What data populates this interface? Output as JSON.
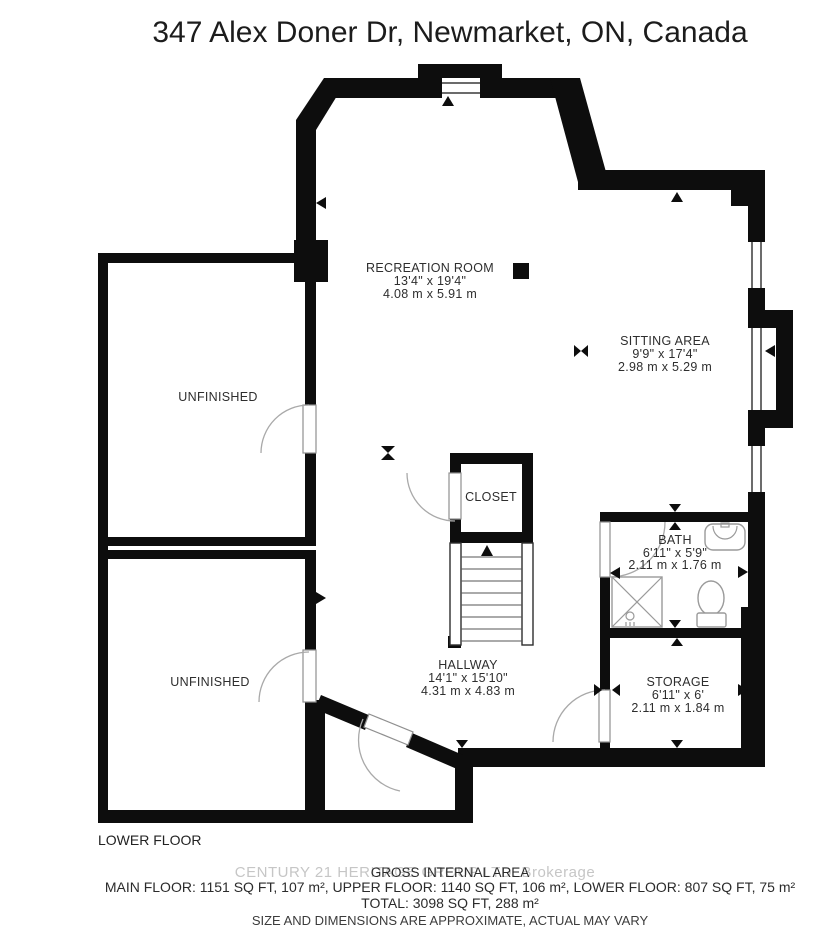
{
  "title": "347 Alex Doner Dr, Newmarket, ON, Canada",
  "floor_label": "LOWER FLOOR",
  "watermark": "CENTURY 21 HERITAGE GROUP LTD. Brokerage",
  "rooms": {
    "recreation": {
      "name": "RECREATION ROOM",
      "imperial": "13'4\" x 19'4\"",
      "metric": "4.08 m x 5.91 m"
    },
    "sitting": {
      "name": "SITTING AREA",
      "imperial": "9'9\" x 17'4\"",
      "metric": "2.98 m x 5.29 m"
    },
    "unfinished_upper": {
      "name": "UNFINISHED"
    },
    "unfinished_lower": {
      "name": "UNFINISHED"
    },
    "closet": {
      "name": "CLOSET"
    },
    "bath": {
      "name": "BATH",
      "imperial": "6'11\" x 5'9\"",
      "metric": "2.11 m x 1.76 m"
    },
    "hallway": {
      "name": "HALLWAY",
      "imperial": "14'1\" x 15'10\"",
      "metric": "4.31 m x 4.83 m"
    },
    "storage": {
      "name": "STORAGE",
      "imperial": "6'11\" x 6'",
      "metric": "2.11 m x 1.84 m"
    }
  },
  "footer": {
    "area_title": "GROSS INTERNAL AREA",
    "area_line1": "MAIN FLOOR: 1151 SQ FT, 107 m², UPPER FLOOR: 1140 SQ FT, 106 m², LOWER FLOOR: 807 SQ FT, 75 m²",
    "area_total": "TOTAL: 3098 SQ FT, 288 m²",
    "disclaimer": "SIZE AND DIMENSIONS ARE APPROXIMATE, ACTUAL MAY VARY"
  },
  "colors": {
    "wall": "#0d0d0d",
    "label_text": "#2e2e2e",
    "watermark": "#c6c6c6"
  }
}
